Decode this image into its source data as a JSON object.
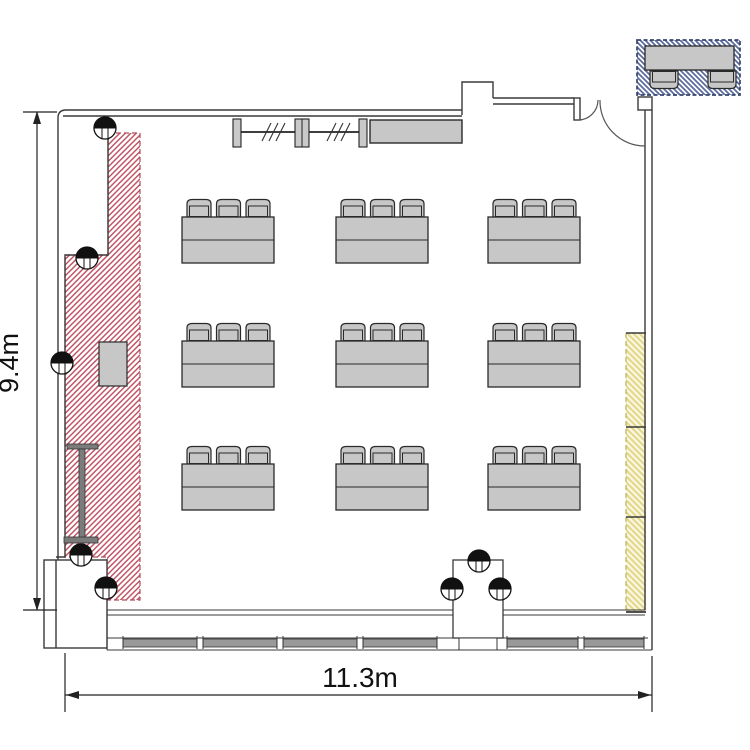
{
  "title": "Meeting room floor plan",
  "dimensions": {
    "height_label": "9.4m",
    "width_label": "11.3m"
  },
  "colors": {
    "wall": "#3a3a3a",
    "thin_line": "#555555",
    "furniture_fill": "#c7c7c7",
    "furniture_stroke": "#2a2a2a",
    "hatch_red": "#c05565",
    "hatch_red_border": "#b04c5c",
    "hatch_yellow": "#e3d88b",
    "hatch_yellow_bg": "#fbf8e6",
    "hatch_yellow_border": "#b9ae5f",
    "hatch_blue": "#5c6c9e",
    "hatch_blue_border": "#37456f",
    "window_bar": "#999999",
    "beam": "#7b7b7b",
    "dimension_text": "#111111"
  },
  "furniture": {
    "table_count": 9,
    "chairs_per_table": 6,
    "table_grid": {
      "rows": 3,
      "cols": 3
    },
    "table_size": {
      "w": 92,
      "h": 46
    },
    "chair_size": {
      "w": 24,
      "h": 19
    },
    "tables": [
      {
        "x": 182,
        "y": 217
      },
      {
        "x": 336,
        "y": 217
      },
      {
        "x": 488,
        "y": 217
      },
      {
        "x": 182,
        "y": 341
      },
      {
        "x": 336,
        "y": 341
      },
      {
        "x": 488,
        "y": 341
      },
      {
        "x": 182,
        "y": 464
      },
      {
        "x": 336,
        "y": 464
      },
      {
        "x": 488,
        "y": 464
      }
    ],
    "columns": [
      {
        "x": 105,
        "y": 128
      },
      {
        "x": 87,
        "y": 258
      },
      {
        "x": 62,
        "y": 363
      },
      {
        "x": 81,
        "y": 555
      },
      {
        "x": 106,
        "y": 588
      },
      {
        "x": 479,
        "y": 561
      },
      {
        "x": 452,
        "y": 589
      },
      {
        "x": 500,
        "y": 589
      }
    ],
    "window_segments": [
      [
        123,
        197
      ],
      [
        203,
        277
      ],
      [
        283,
        357
      ],
      [
        363,
        437
      ],
      [
        507,
        578
      ],
      [
        584,
        644
      ]
    ],
    "outside_unit": {
      "table": {
        "x": 645,
        "y": 46,
        "w": 89,
        "h": 24
      },
      "chairs": [
        {
          "x": 650,
          "y": 62
        },
        {
          "x": 708,
          "y": 62
        }
      ]
    }
  },
  "zones": [
    {
      "id": "red",
      "name": "left-hatched-zone",
      "border": "dashed",
      "hatch": "diagonal"
    },
    {
      "id": "yellow",
      "name": "right-wall-strip",
      "segments": 3,
      "hatch": "diagonal"
    },
    {
      "id": "blue",
      "name": "outside-table-unit",
      "location": "top-right-outside",
      "hatch": "diagonal"
    }
  ]
}
